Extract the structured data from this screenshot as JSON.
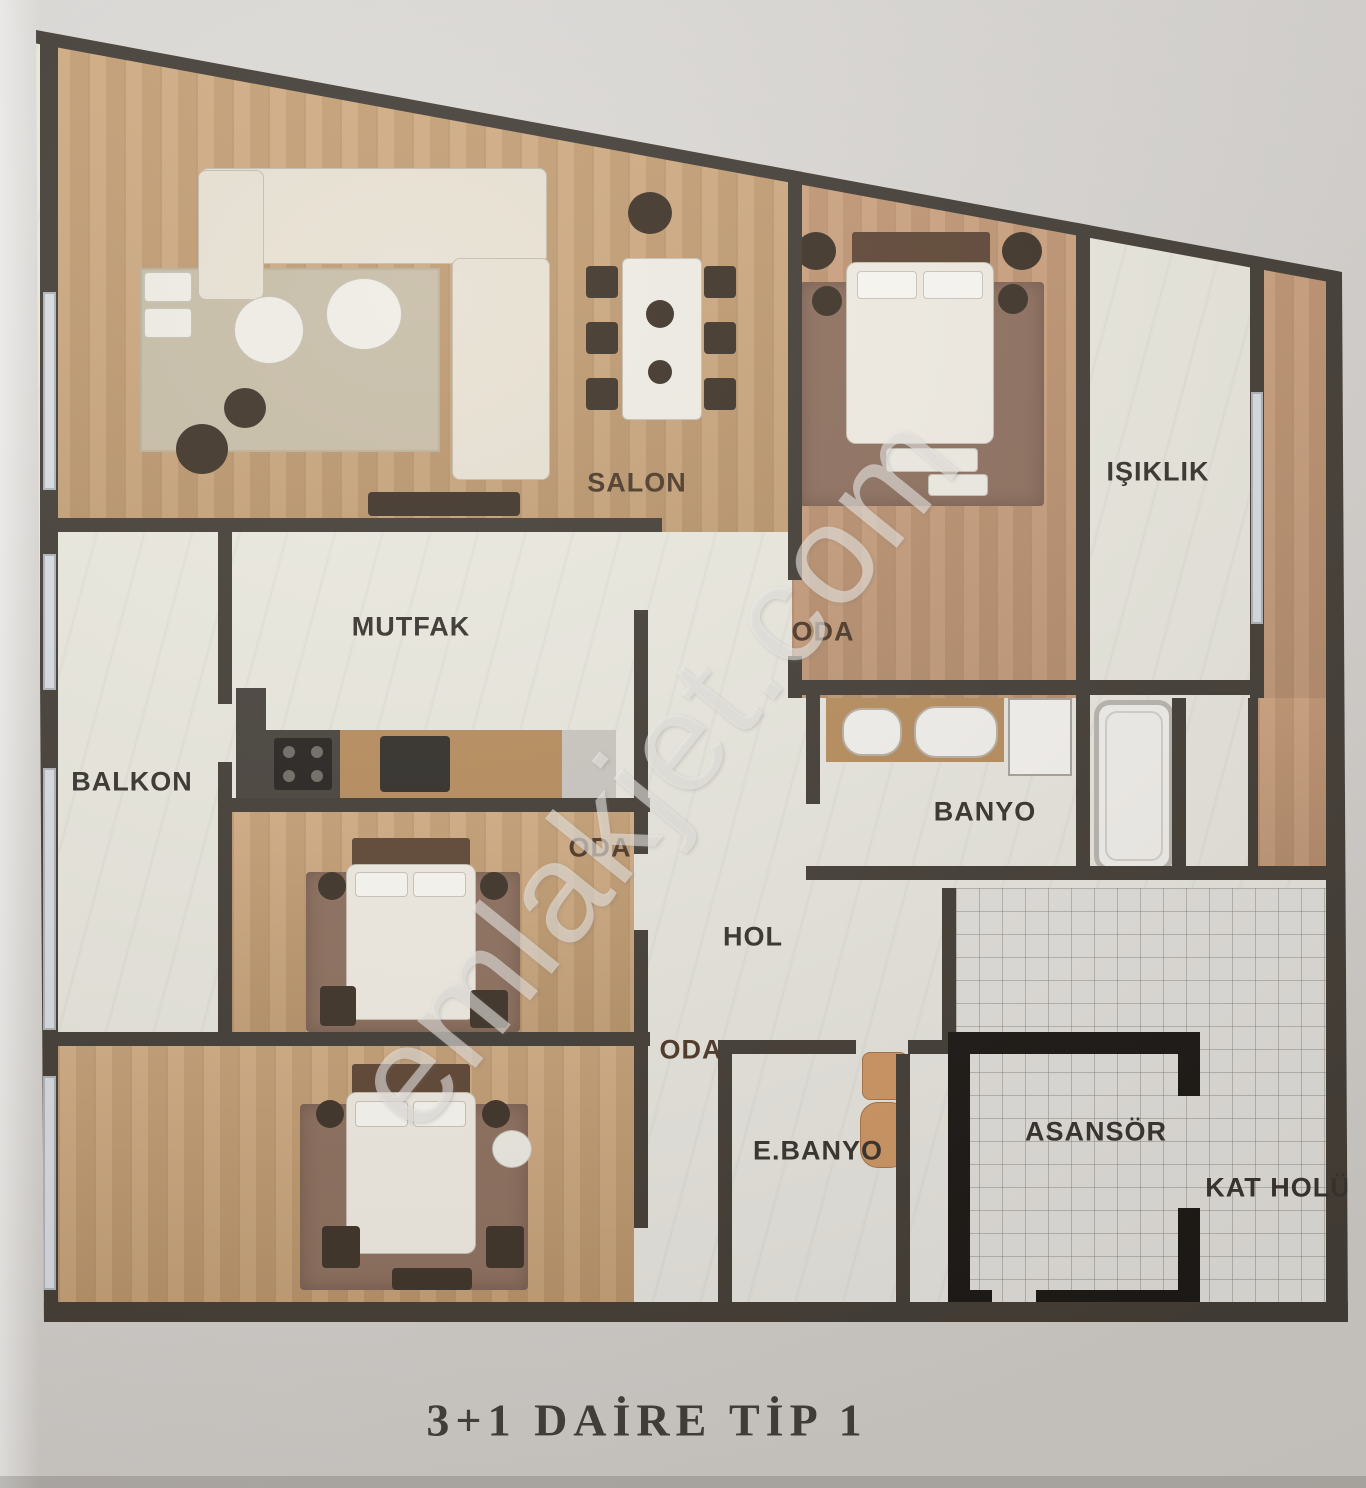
{
  "title": "3+1 DAİRE TİP 1",
  "watermark": "emlakjet.com",
  "rooms": [
    {
      "id": "salon",
      "label": "SALON"
    },
    {
      "id": "oda-top",
      "label": "ODA"
    },
    {
      "id": "isiklik",
      "label": "IŞIKLIK"
    },
    {
      "id": "mutfak",
      "label": "MUTFAK"
    },
    {
      "id": "balkon",
      "label": "BALKON"
    },
    {
      "id": "banyo",
      "label": "BANYO"
    },
    {
      "id": "oda-middle",
      "label": "ODA"
    },
    {
      "id": "hol",
      "label": "HOL"
    },
    {
      "id": "oda-bottom",
      "label": "ODA"
    },
    {
      "id": "ebanyo",
      "label": "E.BANYO"
    },
    {
      "id": "asansor",
      "label": "ASANSÖR"
    },
    {
      "id": "kat-holu",
      "label": "KAT HOLÜ"
    }
  ],
  "colors": {
    "wall": "#413b34",
    "elevator_wall": "#181512",
    "wood_floor": "#c9a67a",
    "marble_floor": "#e9e7e3",
    "tile_line": "#8b857c",
    "window": "#d9dee3",
    "label_dark": "#35302b",
    "label_wood": "#4a3626",
    "photo_background": "#d7d4d1"
  }
}
